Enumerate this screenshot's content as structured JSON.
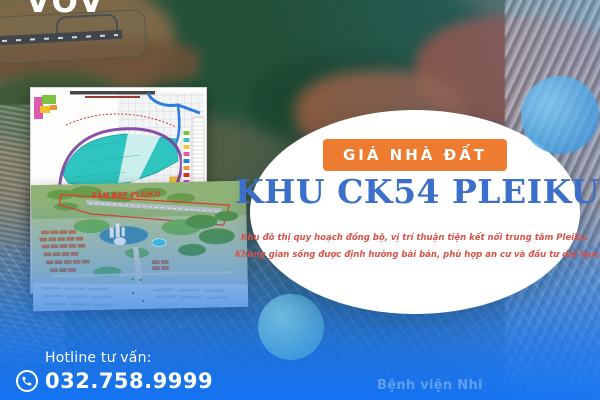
{
  "brand": {
    "logo": "VOV"
  },
  "hero": {
    "badge_label": "GIÁ NHÀ ĐẤT",
    "title": "KHU CK54 PLEIKU",
    "description": [
      "Khu đô thị quy hoạch đồng bộ, vị trí thuận tiện kết nối trung tâm Pleiku.",
      "Không gian sống được định hướng bài bản, phù hợp an cư và đầu tư dài hạn."
    ]
  },
  "hotline": {
    "label": "Hotline tư vấn:",
    "number": "032.758.9999",
    "icon": "phone-icon"
  },
  "insets": {
    "planning_map": {
      "name": "zoning-plan-map"
    },
    "render": {
      "airport_label": "SÂN BAY PLEIKU"
    }
  },
  "background": {
    "map_label_hospital": "Bệnh viện Nhi"
  },
  "colors": {
    "badge_orange": "#ED7C31",
    "title_blue": "#3B6FC9",
    "description_red": "#D9534A",
    "overlay_blue": "#1473F2",
    "accent_circle_blue": "#4AA9E8"
  }
}
